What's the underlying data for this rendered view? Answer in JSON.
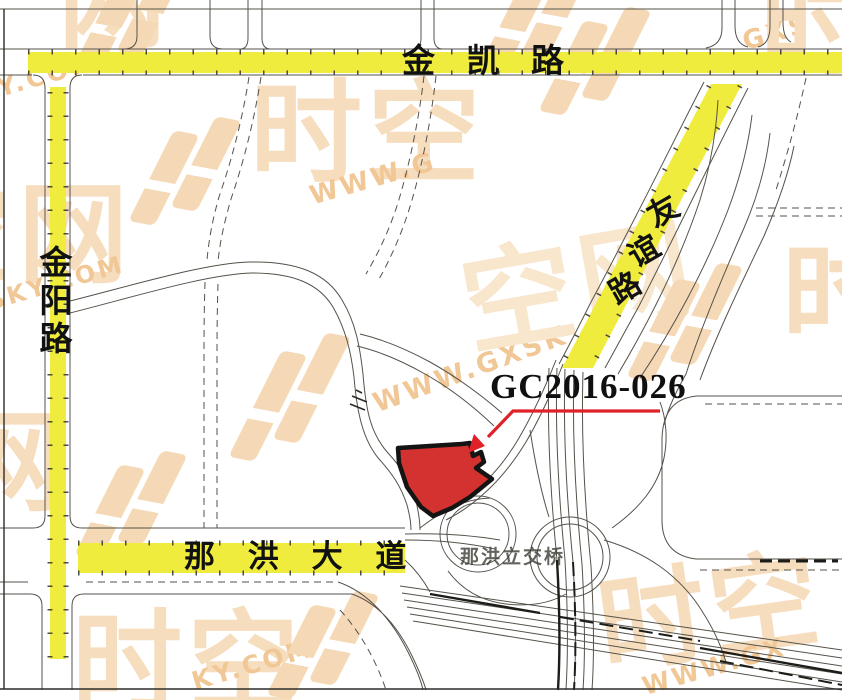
{
  "map": {
    "region_labels": {
      "parcel_code": "GC2016-026",
      "interchange": "那洪立交桥"
    },
    "roads": {
      "jinkai_road": "金 凯 路",
      "jinyang_chars": [
        "金",
        "阳",
        "路"
      ],
      "youyi_chars": [
        "友",
        "谊",
        "路"
      ],
      "nahong_avenue": "那 洪 大 道"
    },
    "watermark": {
      "brand_full": "时空网",
      "brand_shi_kong": "时空",
      "brand_kong_wang": "空网",
      "brand_wang": "网",
      "brand_shi": "时",
      "url_full": "WWW.GXSKY.COM",
      "url_y_com": "Y.COM",
      "url_www_g": "WWW.G",
      "url_gxs": "GXS",
      "url_xsky_com": "XSKY.COM",
      "url_www_gxsk": "WWW.GXSK",
      "url_ky_com": "KY.COM",
      "url_www_gx": "WWW.GX"
    },
    "colors": {
      "highlight_road_yellow": "#f0ec3d",
      "parcel_red": "#d33230",
      "parcel_outline": "#141414",
      "leader_red": "#e02128",
      "watermark_glyph": "#f6ddbd",
      "watermark_text": "#f0c795",
      "road_line": "#55524a"
    }
  }
}
